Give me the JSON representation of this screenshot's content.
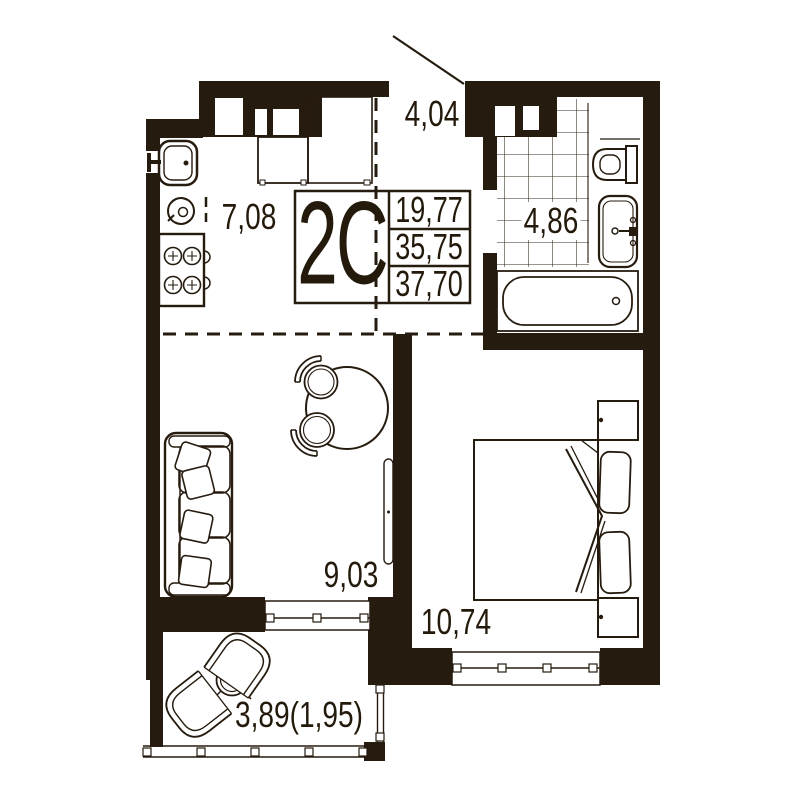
{
  "plan": {
    "unit": {
      "label": "2C",
      "living_area": "19,77",
      "floor_area": "35,75",
      "total_area": "37,70"
    },
    "rooms": {
      "hallway": {
        "area": "4,04"
      },
      "kitchen": {
        "area": "7,08"
      },
      "bathroom": {
        "area": "4,86"
      },
      "living_room": {
        "area": "9,03"
      },
      "bedroom": {
        "area": "10,74"
      },
      "balcony": {
        "area": "3,89(1,95)"
      }
    },
    "colors": {
      "wall": "#261b0f",
      "background": "#ffffff"
    }
  }
}
